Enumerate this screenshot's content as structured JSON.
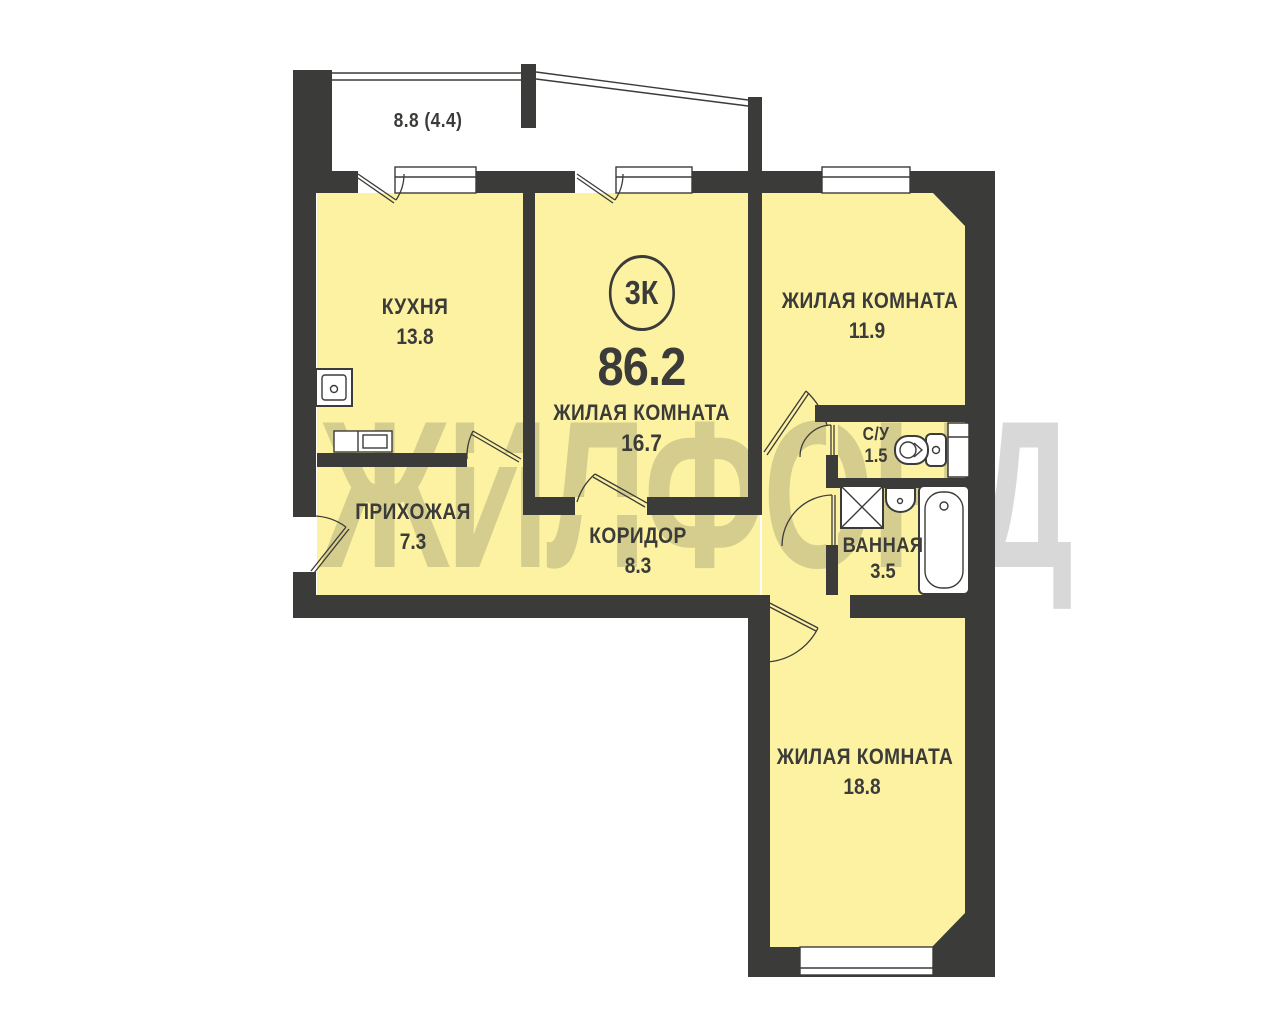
{
  "plan": {
    "title_badge": {
      "rooms_label": "3К",
      "total_area": "86.2"
    },
    "balcony": {
      "area_label": "8.8 (4.4)"
    },
    "rooms": [
      {
        "id": "kitchen",
        "name": "КУХНЯ",
        "area": "13.8"
      },
      {
        "id": "living-center",
        "name": "ЖИЛАЯ КОМНАТА",
        "area": "16.7"
      },
      {
        "id": "living-top-right",
        "name": "ЖИЛАЯ КОМНАТА",
        "area": "11.9"
      },
      {
        "id": "wc",
        "name": "С/У",
        "area": "1.5"
      },
      {
        "id": "bathroom",
        "name": "ВАННАЯ",
        "area": "3.5"
      },
      {
        "id": "hallway",
        "name": "ПРИХОЖАЯ",
        "area": "7.3"
      },
      {
        "id": "corridor",
        "name": "КОРИДОР",
        "area": "8.3"
      },
      {
        "id": "living-bottom-right",
        "name": "ЖИЛАЯ КОМНАТА",
        "area": "18.8"
      }
    ],
    "watermark": "ЖИЛФОНД",
    "icons": [
      "kitchen-sink-icon",
      "kitchen-counter-icon",
      "toilet-icon",
      "cabinet-icon",
      "washing-machine-icon",
      "bathroom-sink-icon",
      "bathtub-icon"
    ],
    "colors": {
      "wall": "#3B3B39",
      "room_fill": "#FCF2A2",
      "background": "#FFFFFF"
    }
  }
}
